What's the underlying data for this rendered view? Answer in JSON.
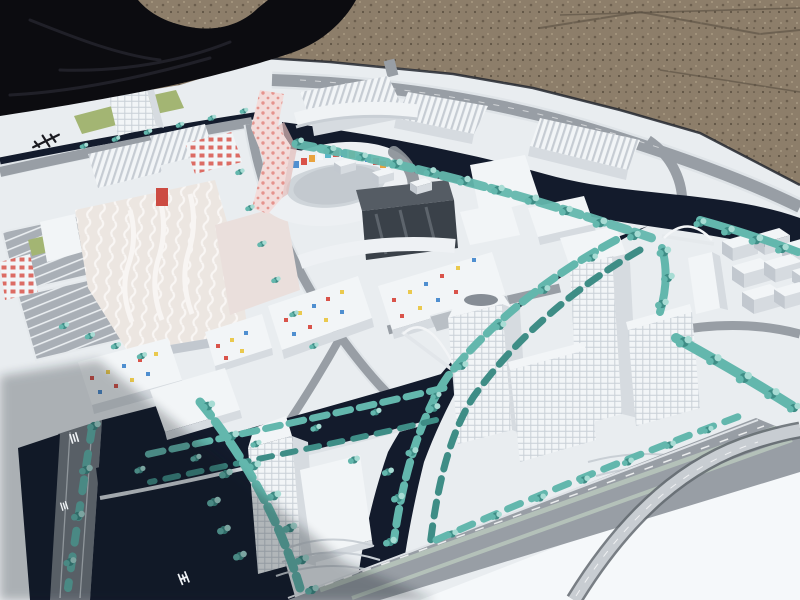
{
  "scene": {
    "caption": "Outdoor photograph of an architectural scale model of a canal-side urban master plan: white model buildings (one tall pink dotted tower, a circular courtyard block with colorful mosaic facades, confetti-dotted housing blocks, white office towers), teal model trees, dark navy canals with white arched bridges and a grey highway with a curved flyover, all on a white base resting on gravel with a black tarp at the upper left.",
    "markings": {
      "base_logo": "small illegible dark maker's mark on the white base",
      "road_stencils": "tiny illegible white stencil characters on the roads"
    }
  },
  "colors": {
    "gravel": "#8d7e6a",
    "gravel_dark": "#6a5d4c",
    "gravel_light": "#a5977f",
    "tarp": "#0c0c10",
    "tarp_fold": "#26262e",
    "base": "#e9edf0",
    "base_bright": "#f5f8fa",
    "water": "#131b2c",
    "road": "#989ea5",
    "road_dark": "#767c84",
    "sidewalk": "#dfe4e8",
    "median": "#b4c1b9",
    "tree": "#63b7ad",
    "tree_dark": "#3e8d86",
    "tree_light": "#a7dcd4",
    "grass": "#a3b573",
    "building": "#f2f5f7",
    "building_side": "#d6dbe0",
    "building_shade": "#c2c8cf",
    "roof_dark": "#8b9198",
    "glass": "#3a4149",
    "pink_tower": "#f3dcda",
    "pink_dot": "#e07a72",
    "mosaic_red": "#d9534a",
    "mosaic_blue": "#4f8fd0",
    "mosaic_orange": "#e9a33e",
    "mosaic_teal": "#59b6c9",
    "confetti_yellow": "#eac94e",
    "shadow": "#10141f"
  }
}
